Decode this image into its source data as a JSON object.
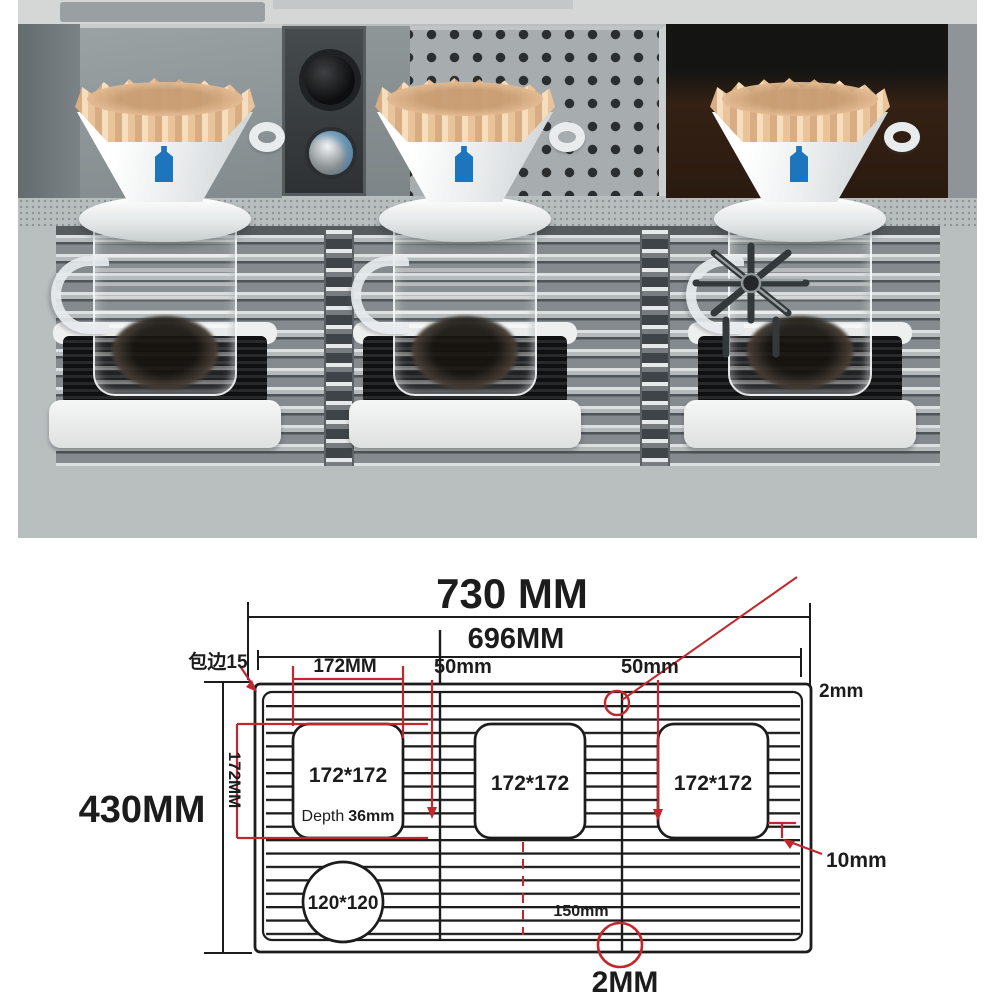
{
  "photo": {
    "station_count": 3,
    "colors": {
      "porcelain": "#f4f6f6",
      "paper_filter": "#e9c49b",
      "logo_blue": "#1d76bd",
      "rubber_mat": "#1a1b1d",
      "stainless": "#a7adaf",
      "coffee": "#241c15"
    }
  },
  "diagram": {
    "colors": {
      "line": "#1c1c1c",
      "dimension_red": "#c1272d"
    },
    "labels": {
      "overall_width": "730 MM",
      "inner_width": "696MM",
      "overall_height": "430MM",
      "edge_wrap": "包边15",
      "cutout_width": "172MM",
      "cutout_height": "172MM",
      "gap_left": "50mm",
      "gap_right": "50mm",
      "rim_thickness": "2mm",
      "cutout1": "172*172",
      "cutout2": "172*172",
      "cutout3": "172*172",
      "depth_label": "Depth",
      "depth_value": "36mm",
      "drain_circle": "120*120",
      "center_distance": "150mm",
      "slat_gap": "10mm",
      "plate_thickness": "2MM"
    }
  }
}
